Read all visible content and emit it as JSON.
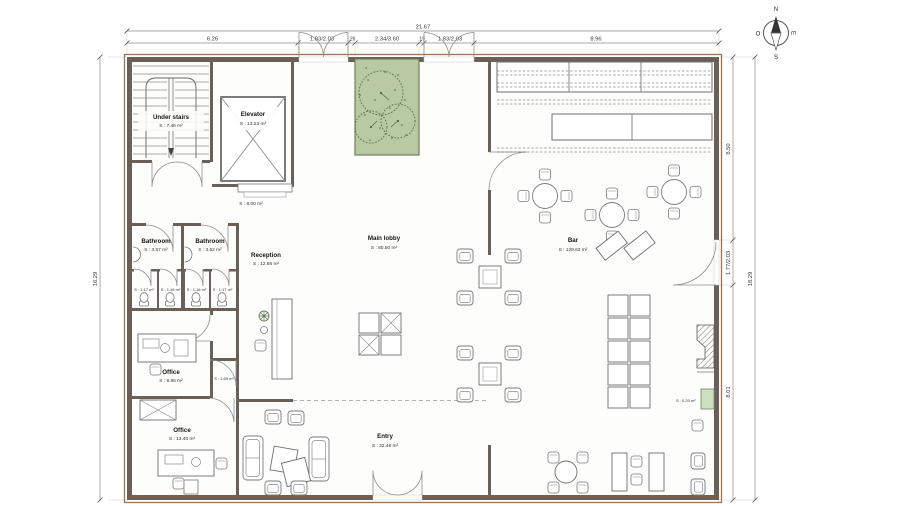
{
  "drawing": {
    "type": "architectural-floor-plan",
    "units": "m"
  },
  "dimensions": {
    "top_total": "21.67",
    "top_segments": [
      "6.26",
      "1.83/2.03",
      ".26",
      "2.34/3.60",
      ".19",
      "1.83/2.03",
      "8.96"
    ],
    "left_total": "16.29",
    "right_segments": [
      "8.50",
      "1.77/2.03",
      "8.01"
    ],
    "right_total": "18.29"
  },
  "rooms": {
    "under_stairs": {
      "name": "Under stairs",
      "area": "S : 7.46 m²"
    },
    "elevator": {
      "name": "Elevator",
      "area": "S : 13.23 m²"
    },
    "hall": {
      "area": "S : 8.00 m²"
    },
    "bathroom_left": {
      "name": "Bathroom",
      "area": "S : 3.57 m²"
    },
    "bathroom_right": {
      "name": "Bathroom",
      "area": "S : 3.62 m²"
    },
    "wc_stalls": {
      "s1": "S : 1.17 m²",
      "s2": "S : 1.16 m²",
      "s3": "S : 1.16 m²",
      "s4": "S : 1.17 m²"
    },
    "reception": {
      "name": "Reception",
      "area": "S : 12.86 m²"
    },
    "office_upper": {
      "name": "Office",
      "area": "S : 9.85 m²"
    },
    "corridor": {
      "area": "S : 1.69 m²"
    },
    "office_lower": {
      "name": "Office",
      "area": "S : 13.40 m²"
    },
    "main_lobby": {
      "name": "Main lobby",
      "area": "S : 80.50 m²"
    },
    "entry": {
      "name": "Entry",
      "area": "S : 32.48 m²"
    },
    "bar": {
      "name": "Bar",
      "area": "S : 129.63 m²"
    },
    "wall_planter": {
      "area": "S : 0.20 m²"
    }
  },
  "compass": {
    "north": "N",
    "south": "S",
    "east": "E",
    "west": "O"
  },
  "colors": {
    "wall": "#6a6058",
    "wall_edge": "#9b7350",
    "planter_green": "#b9c9a1",
    "planter_stroke": "#6f7f5c",
    "small_planter_green": "#cfe0c0",
    "tree_stroke": "#4e6a43",
    "furniture_line": "#7a7a7a",
    "dimension_line": "#8a8a8a"
  }
}
